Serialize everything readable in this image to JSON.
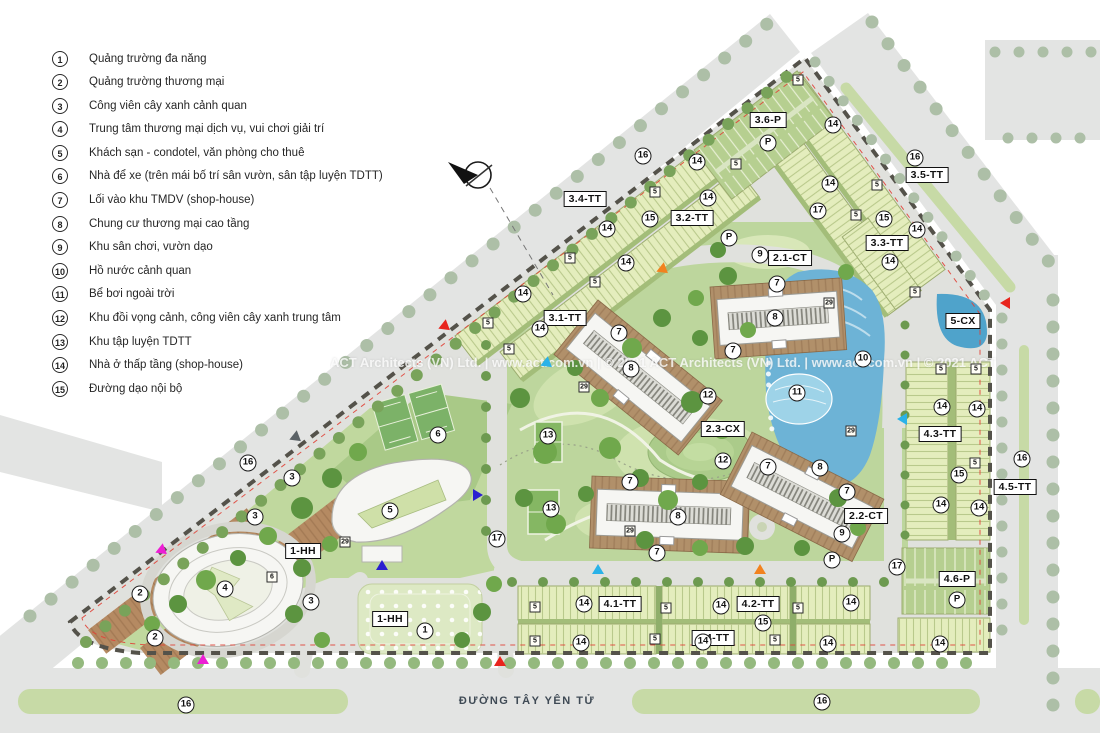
{
  "legend": {
    "items": [
      {
        "num": "1",
        "label": "Quảng trường đa năng"
      },
      {
        "num": "2",
        "label": "Quảng trường thương mại"
      },
      {
        "num": "3",
        "label": "Công viên cây xanh cảnh quan"
      },
      {
        "num": "4",
        "label": "Trung tâm thương mại dịch vụ, vui chơi giải trí"
      },
      {
        "num": "5",
        "label": "Khách sạn - condotel, văn phòng cho thuê"
      },
      {
        "num": "6",
        "label": "Nhà để xe (trên mái bố trí sân vườn, sân tập luyện TDTT)"
      },
      {
        "num": "7",
        "label": "Lối vào khu TMDV (shop-house)"
      },
      {
        "num": "8",
        "label": "Chung cư thương mại cao tầng"
      },
      {
        "num": "9",
        "label": "Khu sân chơi, vườn dạo"
      },
      {
        "num": "10",
        "label": "Hồ nước cảnh quan"
      },
      {
        "num": "11",
        "label": "Bể bơi ngoài trời"
      },
      {
        "num": "12",
        "label": "Khu đồi vọng cảnh, công viên cây xanh trung tâm"
      },
      {
        "num": "13",
        "label": "Khu tập luyện TDTT"
      },
      {
        "num": "14",
        "label": "Nhà ở thấp tầng (shop-house)"
      },
      {
        "num": "15",
        "label": "Đường dạo nội bộ"
      }
    ]
  },
  "map": {
    "road_name": "ĐƯỜNG TÂY YÊN TỬ",
    "watermark": "ACT Architects (VN) Ltd.  |  www.act.com.vn  |  © 2021 ACT Architects (VN) Ltd.  |  www.act.com.vn  |  © 2021 ACT",
    "zone_labels": [
      {
        "text": "3.6-P",
        "x": 768,
        "y": 120
      },
      {
        "text": "3.4-TT",
        "x": 585,
        "y": 199
      },
      {
        "text": "3.5-TT",
        "x": 927,
        "y": 175
      },
      {
        "text": "3.2-TT",
        "x": 692,
        "y": 218
      },
      {
        "text": "3.3-TT",
        "x": 887,
        "y": 243
      },
      {
        "text": "3.1-TT",
        "x": 565,
        "y": 318
      },
      {
        "text": "2.1-CT",
        "x": 790,
        "y": 258
      },
      {
        "text": "5-CX",
        "x": 963,
        "y": 321
      },
      {
        "text": "2.3-CX",
        "x": 723,
        "y": 429
      },
      {
        "text": "4.3-TT",
        "x": 940,
        "y": 434
      },
      {
        "text": "4.5-TT",
        "x": 1015,
        "y": 487
      },
      {
        "text": "2.2-CT",
        "x": 866,
        "y": 516
      },
      {
        "text": "4.1-TT",
        "x": 620,
        "y": 604
      },
      {
        "text": "4.2-TT",
        "x": 758,
        "y": 604
      },
      {
        "text": "4.4-TT",
        "x": 713,
        "y": 638
      },
      {
        "text": "4.6-P",
        "x": 957,
        "y": 579
      },
      {
        "text": "1-HH",
        "x": 303,
        "y": 551
      },
      {
        "text": "1-HH",
        "x": 390,
        "y": 619
      }
    ],
    "circles": [
      {
        "text": "1",
        "x": 425,
        "y": 631
      },
      {
        "text": "2",
        "x": 140,
        "y": 594
      },
      {
        "text": "2",
        "x": 155,
        "y": 638
      },
      {
        "text": "3",
        "x": 292,
        "y": 478
      },
      {
        "text": "3",
        "x": 255,
        "y": 517
      },
      {
        "text": "3",
        "x": 311,
        "y": 602
      },
      {
        "text": "4",
        "x": 225,
        "y": 589
      },
      {
        "text": "5",
        "x": 390,
        "y": 511
      },
      {
        "text": "6",
        "x": 438,
        "y": 435
      },
      {
        "text": "7",
        "x": 777,
        "y": 284
      },
      {
        "text": "7",
        "x": 733,
        "y": 351
      },
      {
        "text": "7",
        "x": 619,
        "y": 333
      },
      {
        "text": "7",
        "x": 630,
        "y": 482
      },
      {
        "text": "7",
        "x": 657,
        "y": 553
      },
      {
        "text": "7",
        "x": 768,
        "y": 467
      },
      {
        "text": "7",
        "x": 847,
        "y": 492
      },
      {
        "text": "8",
        "x": 775,
        "y": 318
      },
      {
        "text": "8",
        "x": 631,
        "y": 369
      },
      {
        "text": "8",
        "x": 678,
        "y": 517
      },
      {
        "text": "8",
        "x": 820,
        "y": 468
      },
      {
        "text": "9",
        "x": 760,
        "y": 255
      },
      {
        "text": "9",
        "x": 842,
        "y": 534
      },
      {
        "text": "10",
        "x": 863,
        "y": 359
      },
      {
        "text": "11",
        "x": 797,
        "y": 393
      },
      {
        "text": "12",
        "x": 708,
        "y": 396
      },
      {
        "text": "12",
        "x": 723,
        "y": 461
      },
      {
        "text": "13",
        "x": 548,
        "y": 436
      },
      {
        "text": "13",
        "x": 551,
        "y": 509
      },
      {
        "text": "14",
        "x": 697,
        "y": 162
      },
      {
        "text": "14",
        "x": 708,
        "y": 198
      },
      {
        "text": "14",
        "x": 607,
        "y": 229
      },
      {
        "text": "14",
        "x": 626,
        "y": 263
      },
      {
        "text": "14",
        "x": 523,
        "y": 294
      },
      {
        "text": "14",
        "x": 540,
        "y": 329
      },
      {
        "text": "14",
        "x": 833,
        "y": 125
      },
      {
        "text": "14",
        "x": 830,
        "y": 184
      },
      {
        "text": "14",
        "x": 917,
        "y": 230
      },
      {
        "text": "14",
        "x": 890,
        "y": 262
      },
      {
        "text": "14",
        "x": 942,
        "y": 407
      },
      {
        "text": "14",
        "x": 977,
        "y": 409
      },
      {
        "text": "14",
        "x": 941,
        "y": 505
      },
      {
        "text": "14",
        "x": 979,
        "y": 508
      },
      {
        "text": "14",
        "x": 584,
        "y": 604
      },
      {
        "text": "14",
        "x": 721,
        "y": 606
      },
      {
        "text": "14",
        "x": 851,
        "y": 603
      },
      {
        "text": "14",
        "x": 581,
        "y": 643
      },
      {
        "text": "14",
        "x": 703,
        "y": 642
      },
      {
        "text": "14",
        "x": 828,
        "y": 644
      },
      {
        "text": "14",
        "x": 940,
        "y": 644
      },
      {
        "text": "15",
        "x": 650,
        "y": 219
      },
      {
        "text": "15",
        "x": 884,
        "y": 219
      },
      {
        "text": "15",
        "x": 959,
        "y": 475
      },
      {
        "text": "15",
        "x": 763,
        "y": 623
      },
      {
        "text": "16",
        "x": 643,
        "y": 156
      },
      {
        "text": "16",
        "x": 915,
        "y": 158
      },
      {
        "text": "16",
        "x": 248,
        "y": 463
      },
      {
        "text": "16",
        "x": 1022,
        "y": 459
      },
      {
        "text": "16",
        "x": 186,
        "y": 705
      },
      {
        "text": "16",
        "x": 822,
        "y": 702
      },
      {
        "text": "17",
        "x": 818,
        "y": 211
      },
      {
        "text": "17",
        "x": 497,
        "y": 539
      },
      {
        "text": "17",
        "x": 897,
        "y": 567
      },
      {
        "text": "P",
        "x": 768,
        "y": 143
      },
      {
        "text": "P",
        "x": 729,
        "y": 238
      },
      {
        "text": "P",
        "x": 832,
        "y": 560
      },
      {
        "text": "P",
        "x": 957,
        "y": 600
      }
    ],
    "badges": [
      {
        "text": "5",
        "x": 798,
        "y": 80
      },
      {
        "text": "5",
        "x": 736,
        "y": 164
      },
      {
        "text": "5",
        "x": 877,
        "y": 185
      },
      {
        "text": "5",
        "x": 856,
        "y": 215
      },
      {
        "text": "5",
        "x": 655,
        "y": 192
      },
      {
        "text": "5",
        "x": 570,
        "y": 258
      },
      {
        "text": "5",
        "x": 595,
        "y": 282
      },
      {
        "text": "5",
        "x": 488,
        "y": 323
      },
      {
        "text": "5",
        "x": 509,
        "y": 349
      },
      {
        "text": "5",
        "x": 915,
        "y": 292
      },
      {
        "text": "5",
        "x": 941,
        "y": 369
      },
      {
        "text": "5",
        "x": 976,
        "y": 369
      },
      {
        "text": "5",
        "x": 975,
        "y": 463
      },
      {
        "text": "5",
        "x": 535,
        "y": 607
      },
      {
        "text": "5",
        "x": 666,
        "y": 608
      },
      {
        "text": "5",
        "x": 798,
        "y": 608
      },
      {
        "text": "5",
        "x": 535,
        "y": 641
      },
      {
        "text": "5",
        "x": 655,
        "y": 639
      },
      {
        "text": "5",
        "x": 775,
        "y": 640
      },
      {
        "text": "29",
        "x": 829,
        "y": 303
      },
      {
        "text": "29",
        "x": 584,
        "y": 387
      },
      {
        "text": "29",
        "x": 851,
        "y": 431
      },
      {
        "text": "29",
        "x": 630,
        "y": 531
      },
      {
        "text": "29",
        "x": 345,
        "y": 542
      },
      {
        "text": "6",
        "x": 272,
        "y": 577
      }
    ],
    "arrows": [
      {
        "c": "#e8251d",
        "r": 128,
        "x": 446,
        "y": 327
      },
      {
        "c": "#e8251d",
        "r": -90,
        "x": 1005,
        "y": 303
      },
      {
        "c": "#e8251d",
        "r": 0,
        "x": 500,
        "y": 661
      },
      {
        "c": "#f2821f",
        "r": 128,
        "x": 664,
        "y": 270
      },
      {
        "c": "#f2821f",
        "r": 0,
        "x": 760,
        "y": 569
      },
      {
        "c": "#2ab2e8",
        "r": 128,
        "x": 548,
        "y": 364
      },
      {
        "c": "#2ab2e8",
        "r": 0,
        "x": 598,
        "y": 569
      },
      {
        "c": "#2ab2e8",
        "r": -90,
        "x": 902,
        "y": 419
      },
      {
        "c": "#ec1fd4",
        "r": 128,
        "x": 163,
        "y": 551
      },
      {
        "c": "#ec1fd4",
        "r": 0,
        "x": 203,
        "y": 659
      },
      {
        "c": "#2a1fd0",
        "r": 0,
        "x": 382,
        "y": 565
      },
      {
        "c": "#2a1fd0",
        "r": 90,
        "x": 478,
        "y": 495
      },
      {
        "c": "#5b6266",
        "r": 128,
        "x": 297,
        "y": 438
      }
    ]
  }
}
